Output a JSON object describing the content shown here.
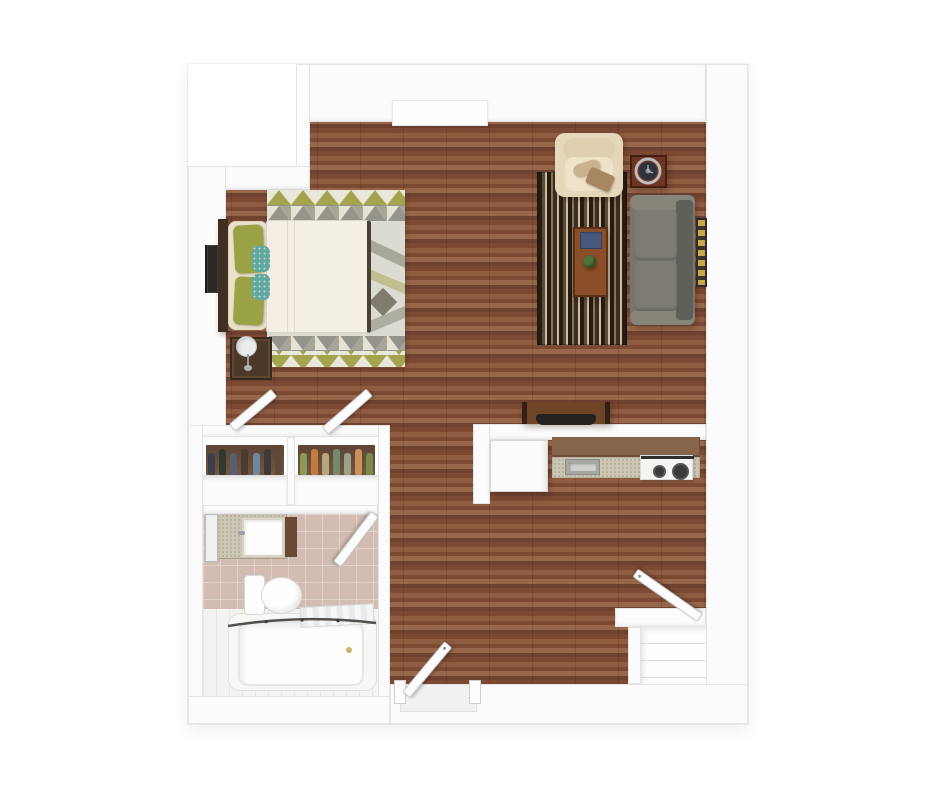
{
  "scene": {
    "kind": "3d-rendered-floor-plan",
    "areas": [
      "bedroom-area",
      "living-area",
      "kitchen",
      "bathroom",
      "closets",
      "entry",
      "entry-closet"
    ],
    "furnishings": {
      "bedroom_area": [
        "bed",
        "headboard",
        "pillows",
        "geometric-rug",
        "nightstand",
        "table-lamp",
        "wall-tv"
      ],
      "living_area": [
        "armchair",
        "throw-pillow",
        "side-table",
        "clock",
        "sofa",
        "striped-rug",
        "coffee-table",
        "book",
        "plant",
        "wall-art",
        "desk",
        "desk-chair"
      ],
      "kitchen": [
        "refrigerator",
        "upper-cabinets",
        "countertop",
        "sink",
        "stove"
      ],
      "bathroom": [
        "vanity",
        "mirror",
        "vanity-sink",
        "toilet",
        "bathtub",
        "shower-rod",
        "towel",
        "bathroom-door"
      ],
      "closets": [
        "left-closet",
        "right-closet",
        "hanging-clothes",
        "closet-doors"
      ],
      "entry": [
        "front-door",
        "threshold"
      ],
      "entry_closet": [
        "shelves",
        "closet-door"
      ]
    }
  },
  "closet_clothes": {
    "left": [
      "#3a3f49",
      "#2e3a2f",
      "#55606e",
      "#4a3c30",
      "#6d89a1",
      "#3b3b3b",
      "#5d4a38"
    ],
    "right": [
      "#8b9a58",
      "#c27b3f",
      "#b3a87c",
      "#75886a",
      "#9aa385",
      "#c9915a",
      "#7c8a4f"
    ]
  },
  "colors": {
    "wall": "#fbfbfb",
    "wall-edge": "#e4e4e4",
    "door": "#fcfcfc",
    "wood-a": "#8e5c41",
    "wood-b": "#7c4a33",
    "wood-c": "#97674b",
    "wood-d": "#6f4230",
    "rug-base": "#dcdbd1",
    "rug-olive": "#a3a350",
    "rug-gray": "#94948a",
    "rug-dark": "#6e6a5e",
    "stripe-dark": "#241d16",
    "stripe-brown": "#5f4a33",
    "stripe-cream": "#cdbd9b",
    "stripe-mid": "#8a7354",
    "sofa": "#77756f",
    "sofa-arm": "#878479",
    "sofa-back": "#615f59",
    "sofa-cushion": "#7d7b74",
    "armchair": "#e6d7ba",
    "armchair-inner": "#eee2c9",
    "duvet": "#f4efe5",
    "pillow-cream": "#eae1cb",
    "pillow-green": "#9aa246",
    "pillow-teal": "#63a8a0",
    "headboard": "#3f2f22",
    "nightstand": "#4c3828",
    "tv": "#2b2725",
    "coffee-table": "#8a4e28",
    "table-edge": "#5a3019",
    "side-table": "#6e3520",
    "book-blue": "#46597a",
    "plant": "#4f7038",
    "desk": "#6f4527",
    "desk-chair": "#26221f",
    "cabinet": "#86654a",
    "counter": "#ccc7b4",
    "fridge": "#fcfcfc",
    "stove": "#f6f5f3",
    "burner": "#3a3a3a",
    "tile": "#d3bdb3",
    "bath-floor": "#f3f3f1",
    "closet-back-a": "#5d4434",
    "closet-back-b": "#74543f",
    "frame-gold": "#caa84a",
    "clock-face": "#2e333b",
    "towel": "#eef0f1"
  }
}
